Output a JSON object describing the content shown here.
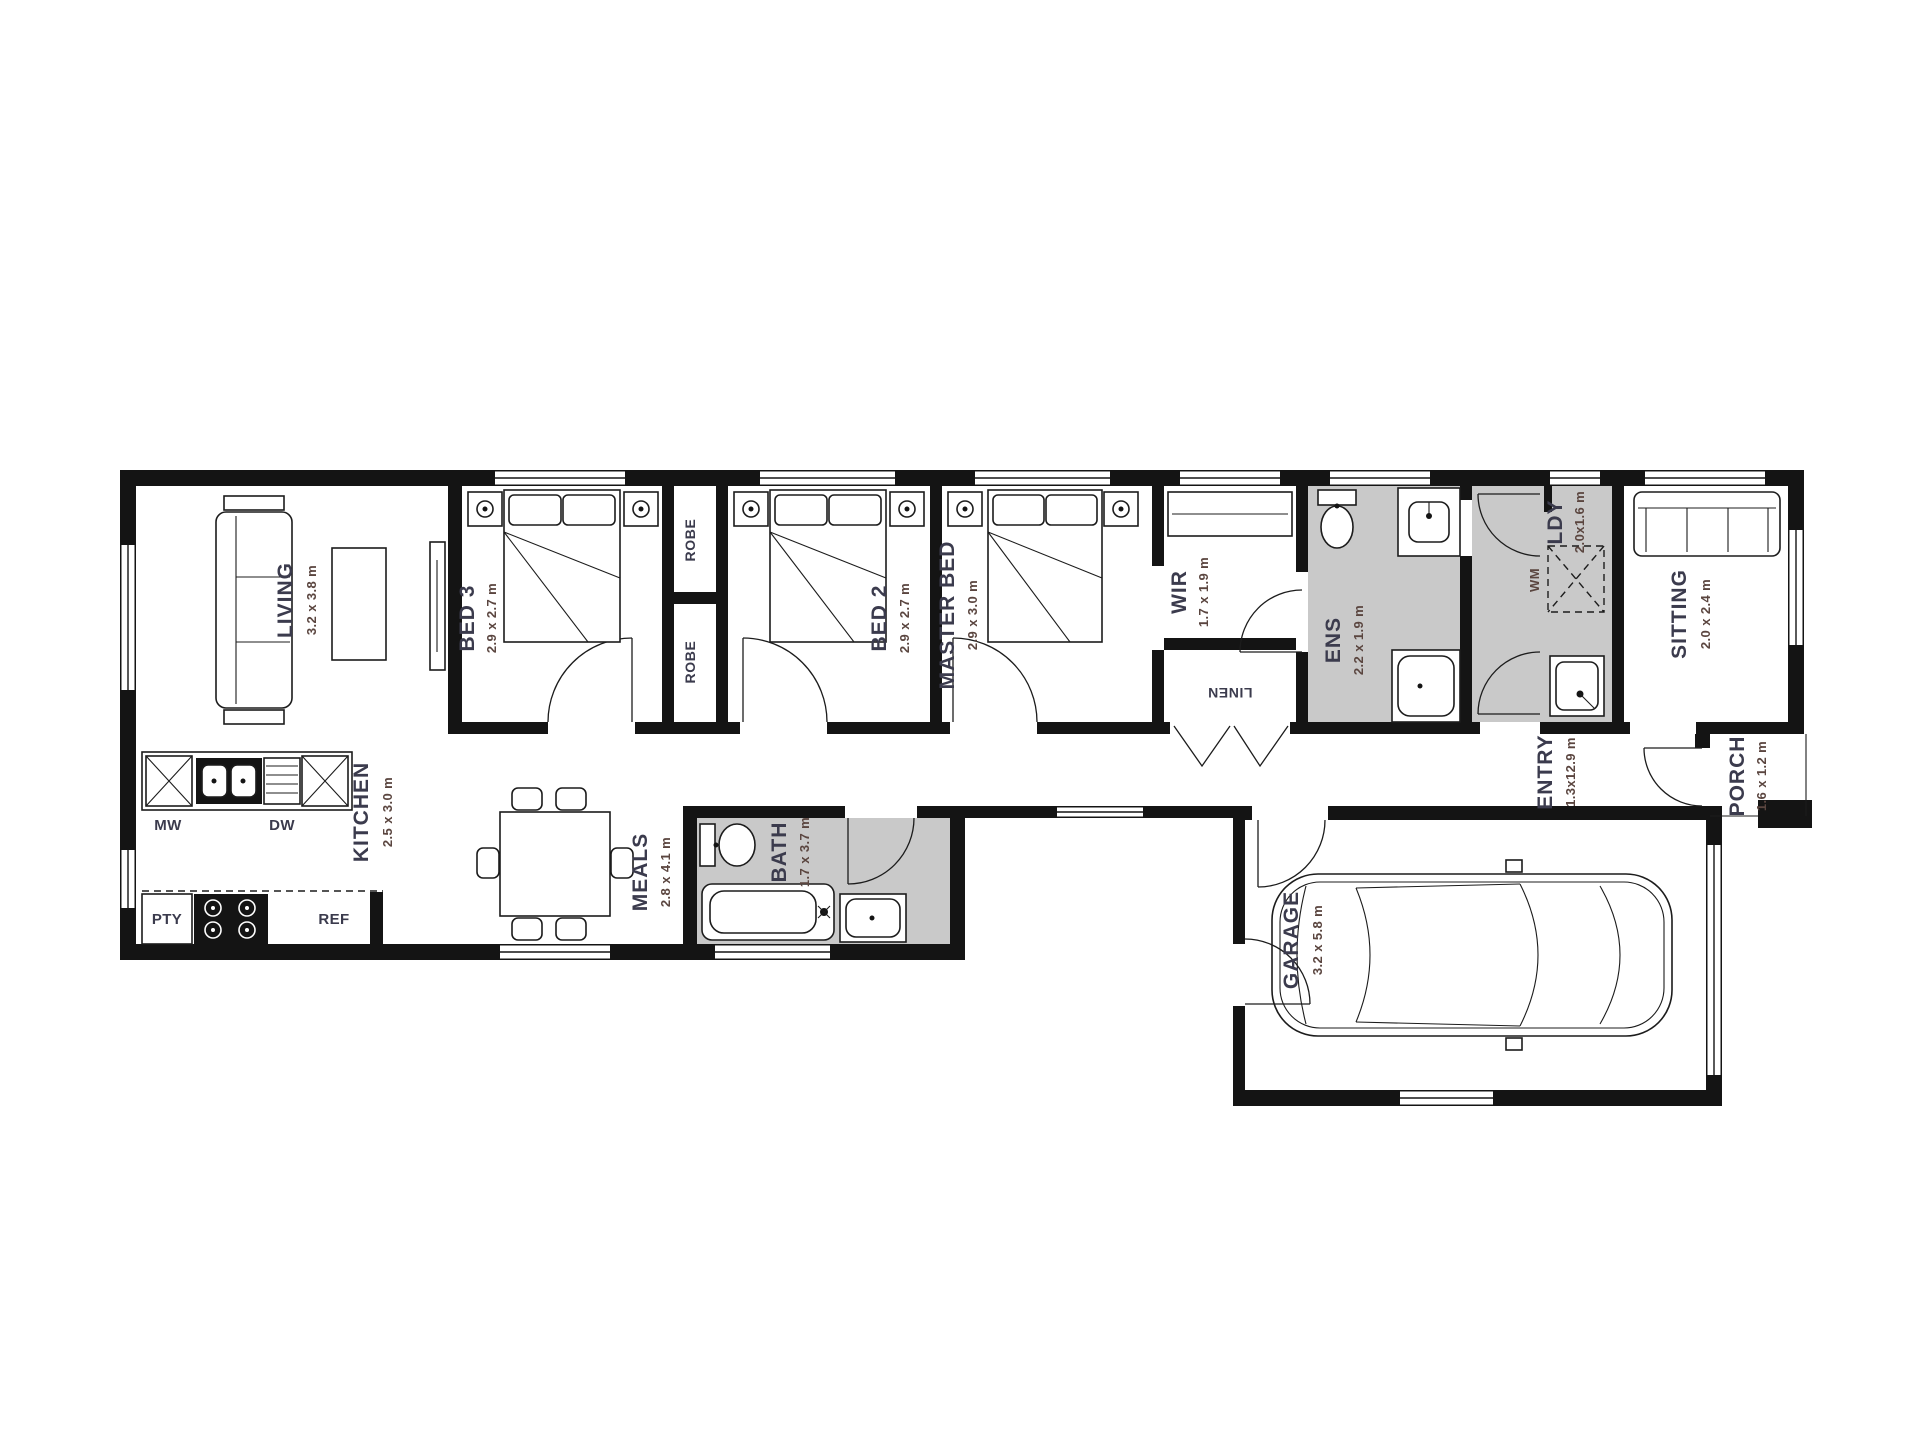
{
  "page": {
    "background": "#ffffff",
    "type": "residential floor plan"
  },
  "colors": {
    "wall": "#141414",
    "tiled_floor": "#c9c9c9",
    "room_name_text": "#3b3b4d",
    "room_dims_text": "#5a453f"
  },
  "rooms": {
    "living": {
      "name": "LIVING",
      "dims": "3.2 x 3.8 m"
    },
    "bed3": {
      "name": "BED 3",
      "dims": "2.9 x 2.7 m"
    },
    "robe_top": {
      "name": "ROBE"
    },
    "robe_bottom": {
      "name": "ROBE"
    },
    "bed2": {
      "name": "BED 2",
      "dims": "2.9 x 2.7 m"
    },
    "master_bed": {
      "name": "MASTER BED",
      "dims": "2.9 x 3.0 m"
    },
    "wir": {
      "name": "WIR",
      "dims": "1.7 x 1.9 m"
    },
    "linen": {
      "name": "LINEN"
    },
    "ens": {
      "name": "ENS",
      "dims": "2.2 x 1.9 m"
    },
    "ldy": {
      "name": "LDY",
      "dims": "2.0x1.6 m"
    },
    "sitting": {
      "name": "SITTING",
      "dims": "2.0 x 2.4 m"
    },
    "entry": {
      "name": "ENTRY",
      "dims": "1.3x12.9 m"
    },
    "porch": {
      "name": "PORCH",
      "dims": "1.6 x 1.2 m"
    },
    "kitchen": {
      "name": "KITCHEN",
      "dims": "2.5 x 3.0 m"
    },
    "meals": {
      "name": "MEALS",
      "dims": "2.8 x 4.1 m"
    },
    "bath": {
      "name": "BATH",
      "dims": "1.7 x 3.7 m"
    },
    "garage": {
      "name": "GARAGE",
      "dims": "3.2 x 5.8 m"
    }
  },
  "appliances": {
    "mw": "MW",
    "dw": "DW",
    "pty": "PTY",
    "ref": "REF",
    "wm": "WM"
  }
}
